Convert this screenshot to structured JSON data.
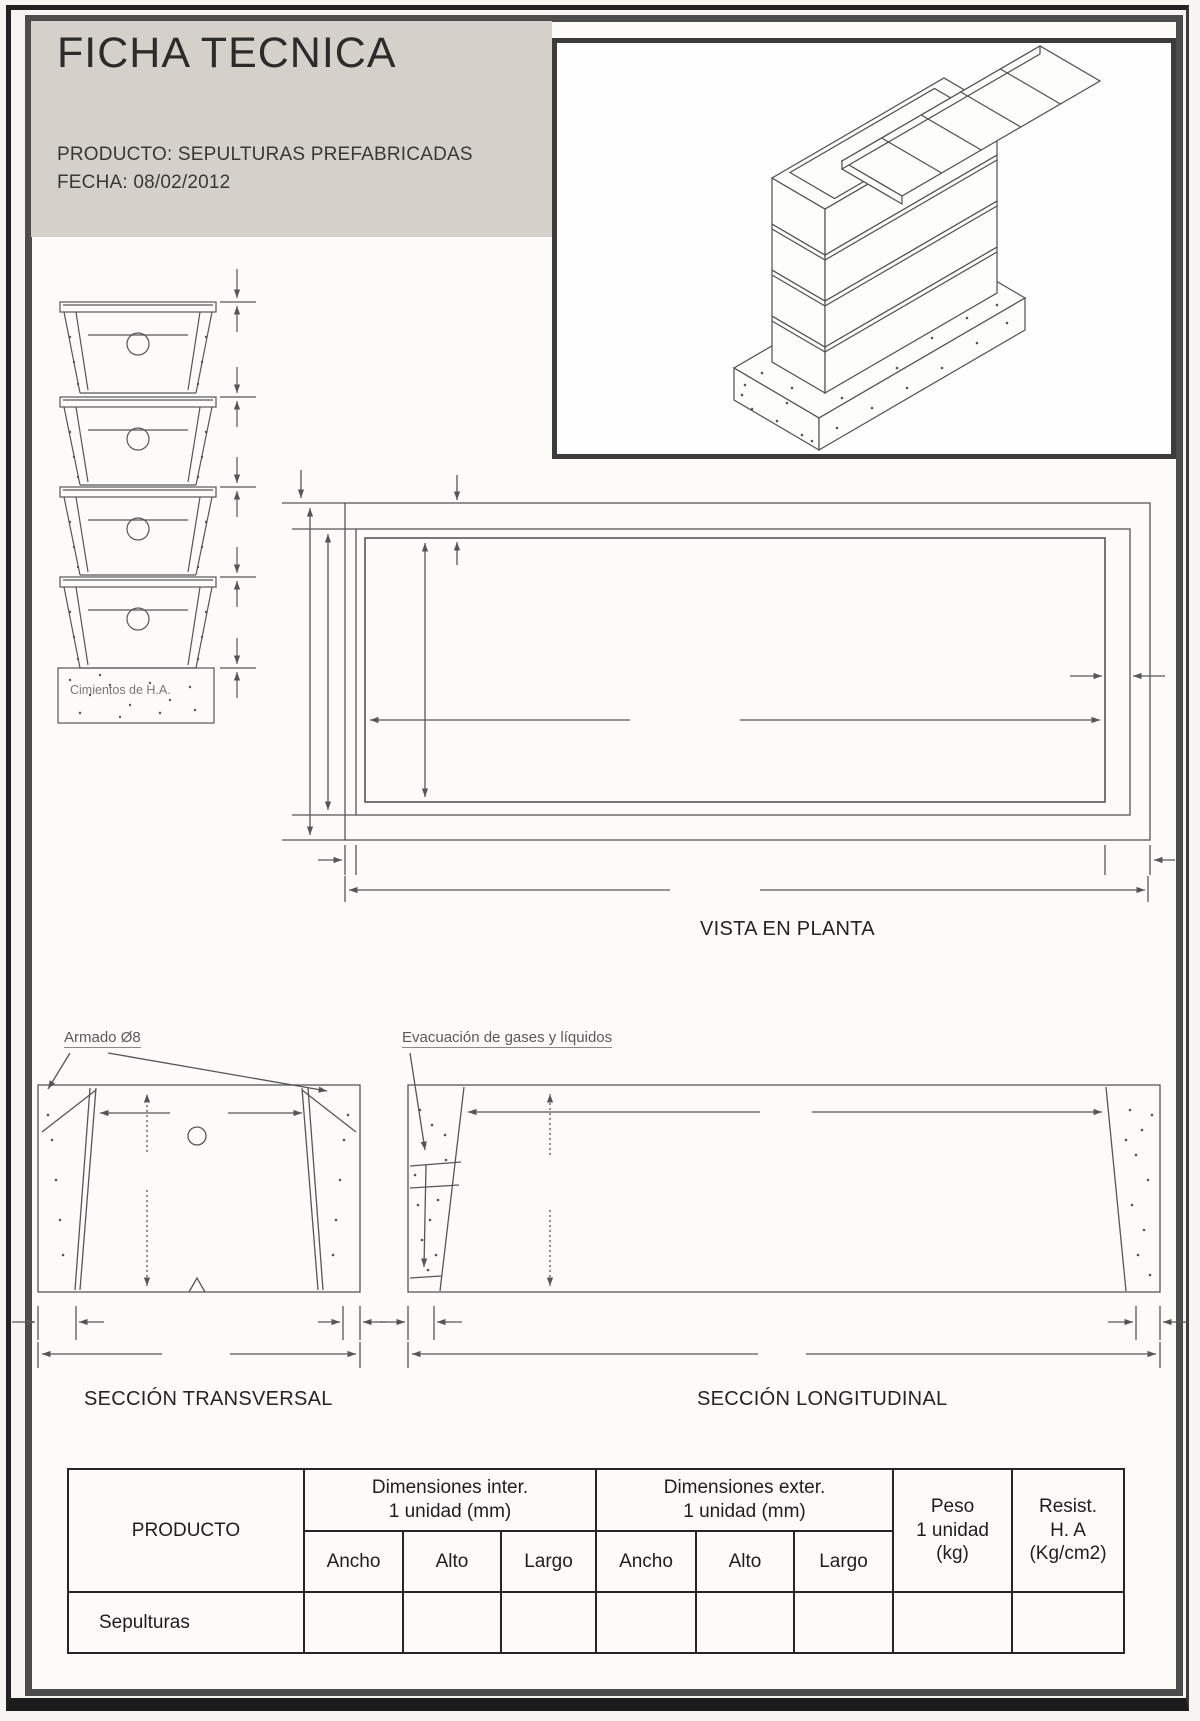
{
  "header": {
    "title": "FICHA TECNICA",
    "product": "PRODUCTO: SEPULTURAS PREFABRICADAS",
    "date": "FECHA: 08/02/2012"
  },
  "labels": {
    "foundation": "Cimientos de H.A.",
    "plan_caption": "VISTA EN PLANTA",
    "reinforcement": "Armado  Ø8",
    "evacuation": "Evacuación de gases y líquidos",
    "transversal_caption": "SECCIÓN TRANSVERSAL",
    "longitudinal_caption": "SECCIÓN LONGITUDINAL"
  },
  "table": {
    "product_header": "PRODUCTO",
    "inner_dims": {
      "line1": "Dimensiones inter.",
      "line2": "1 unidad (mm)",
      "columns": [
        "Ancho",
        "Alto",
        "Largo"
      ]
    },
    "outer_dims": {
      "line1": "Dimensiones exter.",
      "line2": "1 unidad (mm)",
      "columns": [
        "Ancho",
        "Alto",
        "Largo"
      ]
    },
    "weight": {
      "line1": "Peso",
      "line2": "1 unidad",
      "line3": "(kg)"
    },
    "resistance": {
      "line1": "Resist.",
      "line2": "H. A",
      "line3": "(Kg/cm2)"
    },
    "rows": [
      {
        "product": "Sepulturas",
        "values": [
          "",
          "",
          "",
          "",
          "",
          "",
          "",
          ""
        ]
      }
    ]
  },
  "colors": {
    "header_bg": "#d5d0c9",
    "frame_outer": "#1c1c1c",
    "frame_inner": "#4c4c4c",
    "ink": "#2d2b29",
    "drawing_line": "#565656"
  }
}
